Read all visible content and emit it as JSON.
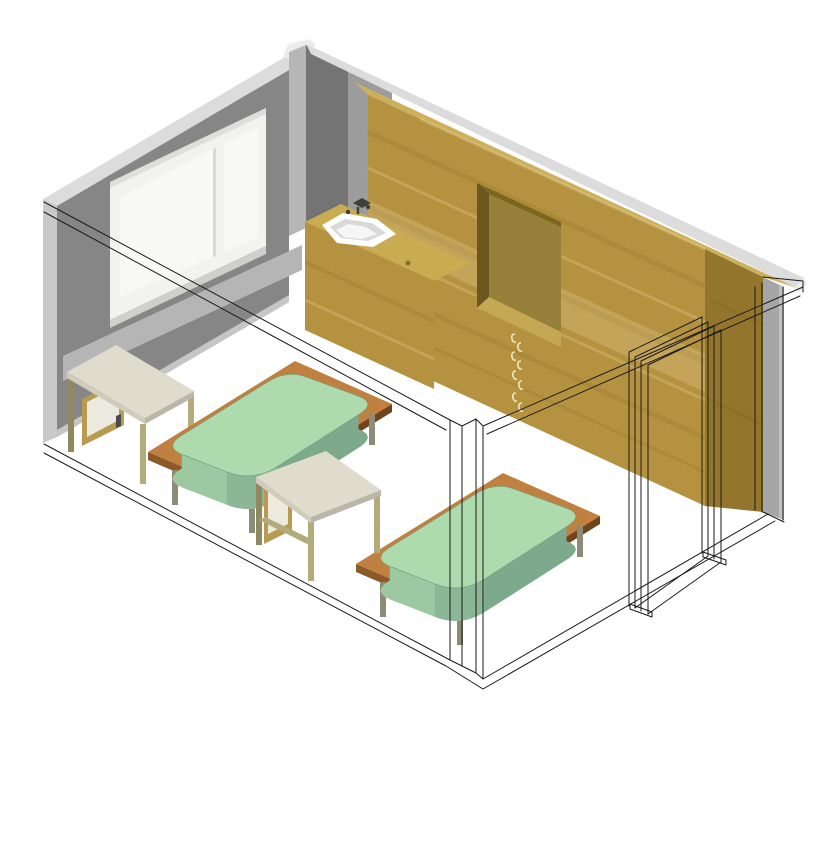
{
  "scene": {
    "title": "Axonometric 3D room view",
    "description": "Cut-away axonometric render of a bedroom: gray wall with window, wood wardrobe wall with niche, sink counter, two beds, two desks, wireframe door and section outlines",
    "objects": [
      "left-wall",
      "window",
      "corner-pilaster",
      "back-wall-top-strip",
      "right-wall",
      "wardrobe-cabinet",
      "niche",
      "drawer-handles",
      "sink-counter",
      "wash-basin",
      "faucet",
      "bed-1",
      "bed-2",
      "desk-1",
      "desk-2",
      "door-frame",
      "section-outline"
    ]
  },
  "colors": {
    "background": "#ffffff",
    "outline": "#1a1a1a",
    "wall_face": "#868686",
    "wall_face_dark": "#747474",
    "wall_face_medium": "#9c9c9c",
    "pilaster_light": "#b6b6b6",
    "wall_cut_light": "#dcdcdc",
    "wall_cut_end": "#c9c9c9",
    "wall_cap": "#ececec",
    "skirting": "#c6c6c6",
    "sill_band": "#b5b5b5",
    "window_frame": "#f2f2f0",
    "window_frame_shade": "#dededb",
    "window_pane": "#f8f8f5",
    "window_mullion_shade": "#d8d8d4",
    "window_sill": "#cfcfcc",
    "right_wall": "#a6a6a6",
    "right_wall_light": "#c0c0c0",
    "wood_front": "#b5923f",
    "wood_top": "#cdb05e",
    "wood_side": "#93762c",
    "wood_grain_dark": "rgba(90,70,10,0.10)",
    "wood_grain_light": "rgba(255,240,190,0.20)",
    "niche_back": "#97803a",
    "niche_left": "#6b571f",
    "niche_top": "#7c661f",
    "niche_sill": "#c5a854",
    "handle": "#efe5bd",
    "knob_wood": "#8a6f2a",
    "counter_top": "#c9ab52",
    "basin": "#ffffff",
    "basin_shade": "#d9d9d9",
    "basin_inner": "#f6f6f6",
    "faucet": "#3f3f3f",
    "mattress_top": "#aedbae",
    "mattress_side": "#9cc8a2",
    "mattress_side_dark": "#7da98c",
    "mattress_corner": "#8cb796",
    "mattress_edge": "#74a083",
    "platform_top": "#c08040",
    "platform_edge": "#8b5a28",
    "platform_edge_dark": "#6e4418",
    "leg_gray": "#8c8c78",
    "desk_top": "#dfdbcd",
    "desk_edge": "#cfccbd",
    "desk_edge_dark": "#bbb7a8",
    "desk_leg": "#b3ab7b",
    "desk_leg_dark": "#8f8860",
    "drawer_front": "#eceadf",
    "drawer_wood": "#b89a50",
    "knob_dark": "#4a4a4a"
  }
}
